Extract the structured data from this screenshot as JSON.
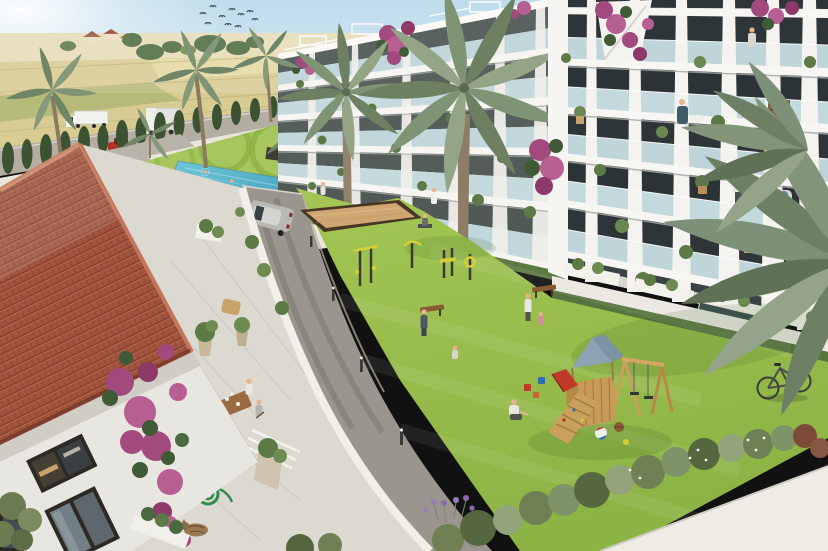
{
  "scene": {
    "title": "Aerial 3D render of a Mediterranean residential complex with central garden courtyard",
    "caption": "Aerial render: white modern apartment blocks with glass balconies surround a green courtyard containing a swimming pool, petanque court, outdoor gym, benches and a wooden playground with swings. A terracotta-tiled house with a terrace, dining family, bougainvillea, garden hose and sleeping cat sits in the left foreground. Farm fields, a road with trucks, a red car, cypress hedge and palm trees fill the background; a silver SUV drives the inner lane; a bicycle leans by a white walkway at lower right under palm fronds.",
    "palette": {
      "sky": "#cfe4ef",
      "fields": "#d9cc92",
      "lawn": "#9cc14f",
      "pool": "#56b4ca",
      "roof_tile": "#a3543d",
      "building_white": "#f2f1ec",
      "glass": "#c2d7db",
      "road_far": "#b3ada2",
      "road_near": "#9a958e",
      "walkway": "#eeece4",
      "sand": "#cfa671",
      "terrace": "#dcd9d1",
      "playground_roof": "#8ba3b3",
      "playground_wood": "#d0a45f",
      "gym_yellow": "#d6ce38",
      "bougainvillea": "#a24a7e",
      "cypress": "#3c5233",
      "palm_frond": "#7d9078",
      "hose_green": "#2e8b4f",
      "car_red": "#b23127",
      "suv_silver": "#bab8b3",
      "truck_white": "#f2f2ee"
    },
    "objects": [
      {
        "name": "farm-fields"
      },
      {
        "name": "farmhouses"
      },
      {
        "name": "bird-flock"
      },
      {
        "name": "background-road"
      },
      {
        "name": "semi-truck"
      },
      {
        "name": "box-truck"
      },
      {
        "name": "red-car"
      },
      {
        "name": "cypress-hedge"
      },
      {
        "name": "palm-trees"
      },
      {
        "name": "swimming-pool"
      },
      {
        "name": "left-apartment-block"
      },
      {
        "name": "right-apartment-block"
      },
      {
        "name": "rooftop-bougainvillea"
      },
      {
        "name": "courtyard-lawn"
      },
      {
        "name": "petanque-court"
      },
      {
        "name": "outdoor-gym"
      },
      {
        "name": "benches"
      },
      {
        "name": "silver-suv"
      },
      {
        "name": "inner-road"
      },
      {
        "name": "playground-tower"
      },
      {
        "name": "swing-set"
      },
      {
        "name": "toys-and-balls"
      },
      {
        "name": "tiled-roof-house"
      },
      {
        "name": "terrace-dining-family"
      },
      {
        "name": "garden-hose"
      },
      {
        "name": "sleeping-cat"
      },
      {
        "name": "bougainvillea-wall"
      },
      {
        "name": "bicycle"
      },
      {
        "name": "white-walkway"
      },
      {
        "name": "shrub-border"
      },
      {
        "name": "lavender"
      },
      {
        "name": "palm-fronds-foreground"
      }
    ],
    "counts": {
      "birds": 10,
      "cypress_trees": 15,
      "vehicles": 4,
      "people_estimate": 16,
      "palm_trees": 9,
      "benches": 2
    }
  }
}
